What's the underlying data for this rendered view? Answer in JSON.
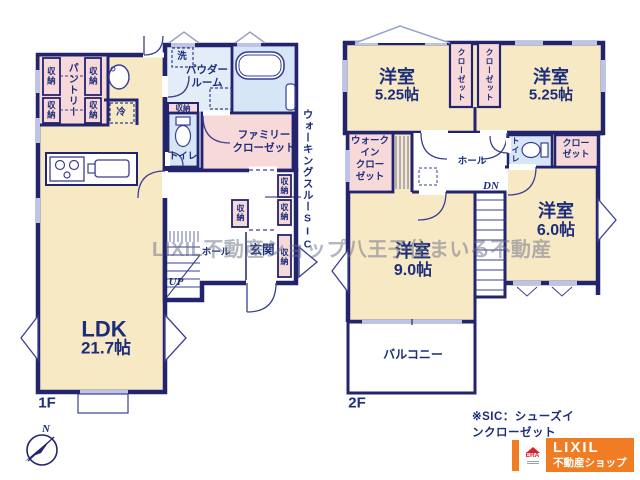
{
  "watermark": "LIXIL不動産ショップ八王子住まいる不動産",
  "floor1": {
    "label": "1F",
    "ldk_name": "LDK",
    "ldk_area": "21.7帖",
    "pantry": "パントリー",
    "fridge": "冷",
    "laundry": "洗",
    "powder_line1": "パウダー",
    "powder_line2": "ルーム",
    "toilet": "トイレ",
    "family_closet_line1": "ファミリー",
    "family_closet_line2": "クローゼット",
    "walk_through_sic": "ウォーキングスルーSIC",
    "hall": "ホール",
    "entrance": "玄関",
    "up": "UP"
  },
  "floor2": {
    "label": "2F",
    "bedroom_nw_name": "洋室",
    "bedroom_nw_area": "5.25帖",
    "bedroom_ne_name": "洋室",
    "bedroom_ne_area": "5.25帖",
    "bedroom_e_name": "洋室",
    "bedroom_e_area": "6.0帖",
    "bedroom_s_name": "洋室",
    "bedroom_s_area": "9.0帖",
    "closet": "クローゼット",
    "wic_line1": "ウォーク",
    "wic_line2": "イン",
    "wic_line3": "クロー",
    "wic_line4": "ゼット",
    "closet_line1": "クロー",
    "closet_line2": "ゼット",
    "hall": "ホール",
    "toilet": "トイレ",
    "dn": "DN",
    "balcony": "バルコニー"
  },
  "shared": {
    "storage": "収納"
  },
  "compass": {
    "north": "N"
  },
  "footer": {
    "sic_note": "※SIC：シューズインクローゼット"
  },
  "logo": {
    "era": "ERA",
    "brand": "LIXIL",
    "brand_sub": "不動産ショップ"
  },
  "colors": {
    "wall_navy": "#23246e",
    "text_navy": "#1c2d7a",
    "room_cream": "#f8e9c5",
    "closet_pink": "#f8d9da",
    "bath_blue": "#d7e6f6",
    "powder_blue": "#e3edf8",
    "window_light": "#bcc5e8",
    "logo_orange": "#f07d23",
    "era_red": "#d8232a"
  }
}
